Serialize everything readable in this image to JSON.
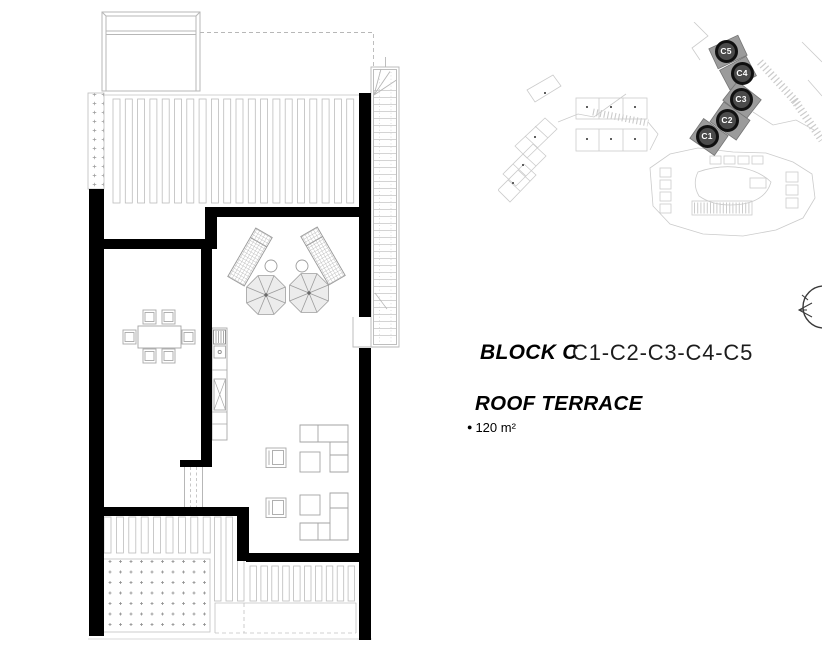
{
  "header": {
    "block_label": "BLOCK C",
    "units_label": "C1-C2-C3-C4-C5",
    "room_label": "ROOF TERRACE",
    "area_bullet": "●",
    "area_label": "120 m²"
  },
  "site_plan": {
    "badges": [
      {
        "id": "c1",
        "label": "C1"
      },
      {
        "id": "c2",
        "label": "C2"
      },
      {
        "id": "c3",
        "label": "C3"
      },
      {
        "id": "c4",
        "label": "C4"
      },
      {
        "id": "c5",
        "label": "C5"
      }
    ],
    "colors": {
      "badge_ring": "#101010",
      "badge_fill": "#4b4b4b",
      "badge_text": "#ffffff",
      "highlighted_building": "#9b9b9b",
      "site_outline": "#cbcbcb"
    }
  },
  "floor_plan": {
    "colors": {
      "wall": "#000000",
      "thin_line": "#b7b7b7"
    }
  },
  "icons": {
    "compass": "north-arrow-icon",
    "bullet": "bullet-icon"
  }
}
